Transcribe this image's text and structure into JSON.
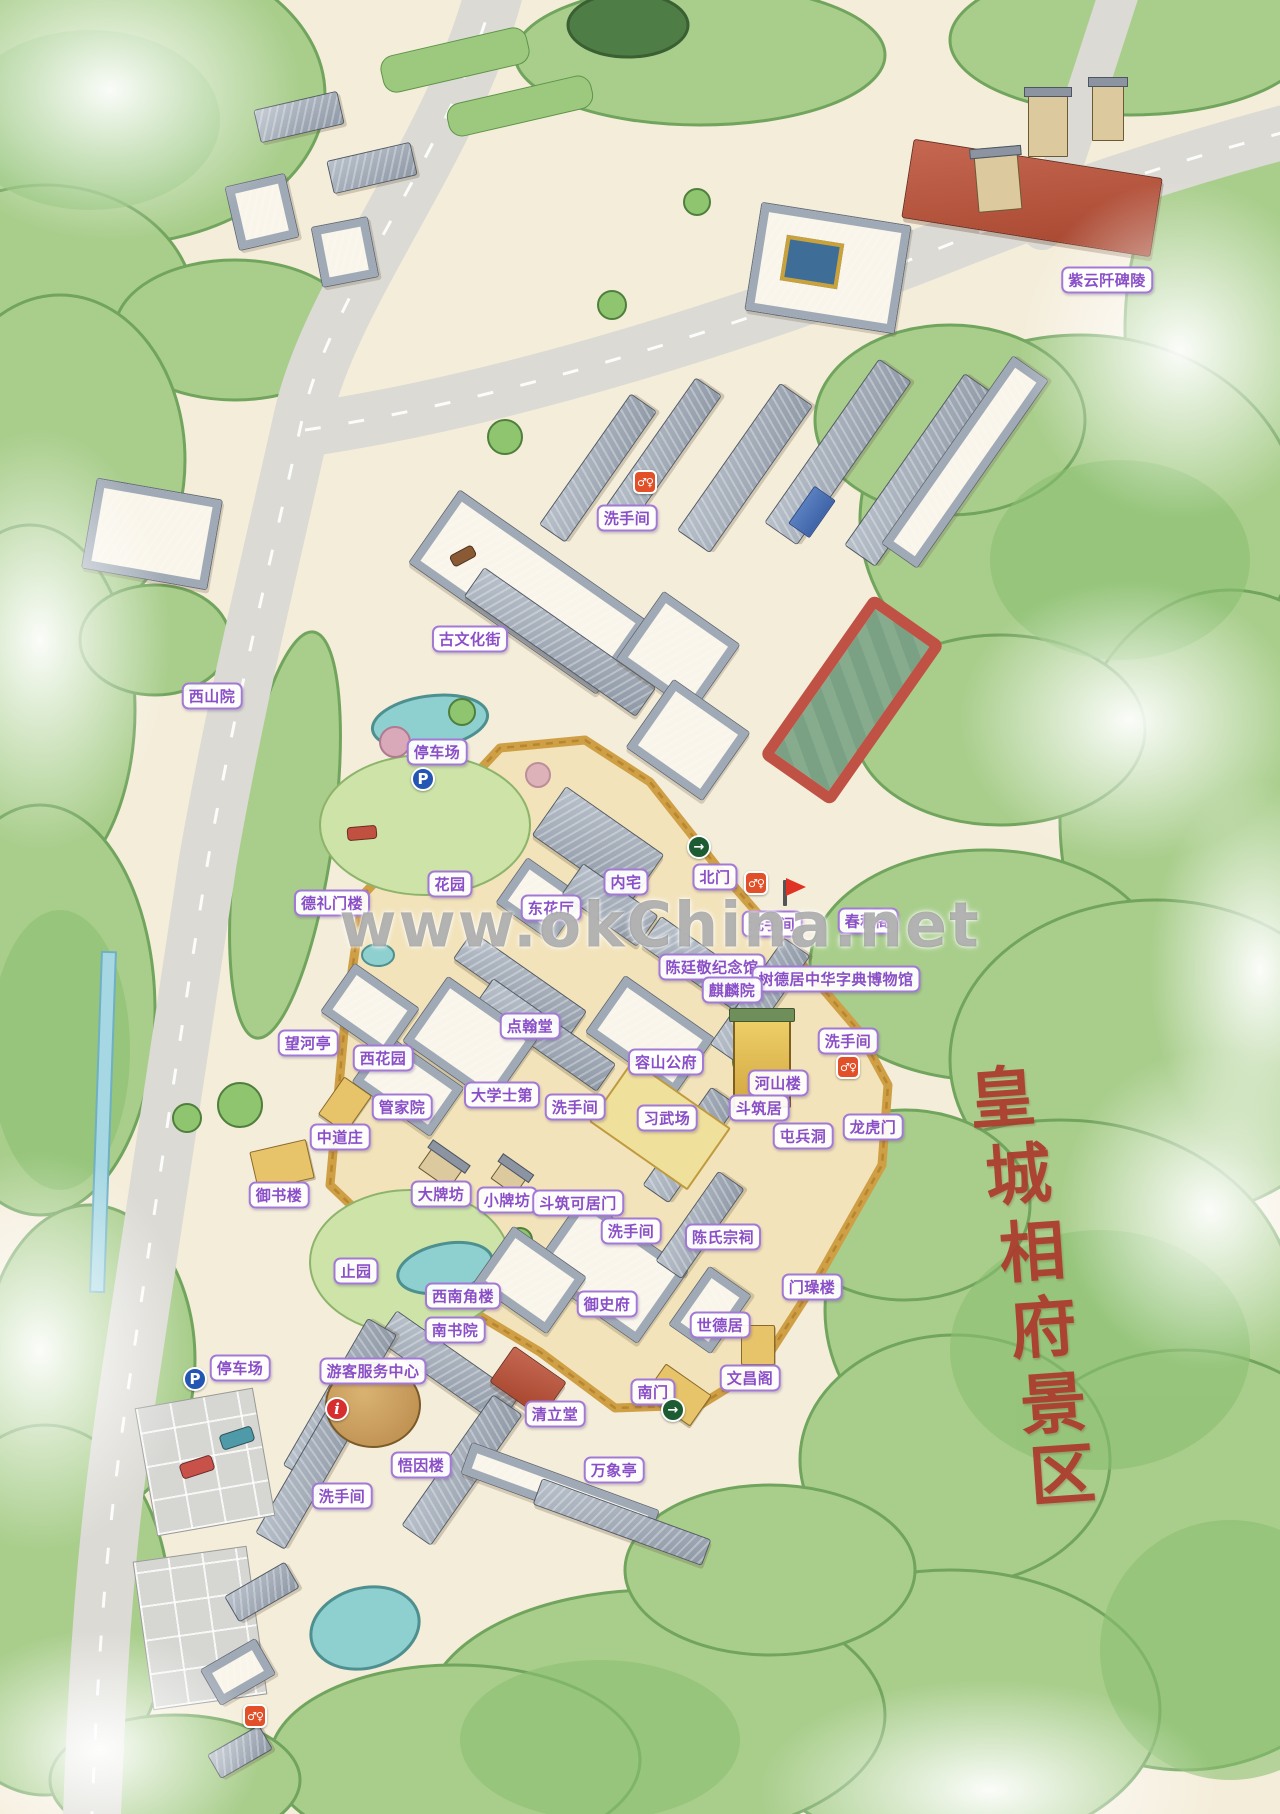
{
  "map": {
    "watermark": "www.okChina.net",
    "vertical_title": {
      "text": "皇城相府景区",
      "color": "#ac3a2d",
      "chars": [
        {
          "ch": "皇",
          "x": 1002,
          "y": 1093
        },
        {
          "ch": "城",
          "x": 1018,
          "y": 1170
        },
        {
          "ch": "相",
          "x": 1032,
          "y": 1247
        },
        {
          "ch": "府",
          "x": 1043,
          "y": 1323
        },
        {
          "ch": "景",
          "x": 1053,
          "y": 1399
        },
        {
          "ch": "区",
          "x": 1062,
          "y": 1470
        }
      ]
    },
    "label_style": {
      "text_color": "#8a4fc8",
      "border_color": "#a379d6",
      "background": "#ffffff"
    },
    "labels": [
      {
        "text": "紫云阡碑陵",
        "x": 1107,
        "y": 280
      },
      {
        "text": "洗手间",
        "x": 627,
        "y": 518
      },
      {
        "text": "古文化街",
        "x": 470,
        "y": 639
      },
      {
        "text": "西山院",
        "x": 212,
        "y": 696
      },
      {
        "text": "停车场",
        "x": 437,
        "y": 752
      },
      {
        "text": "花园",
        "x": 450,
        "y": 884
      },
      {
        "text": "德礼门楼",
        "x": 332,
        "y": 903
      },
      {
        "text": "内宅",
        "x": 626,
        "y": 882
      },
      {
        "text": "北门",
        "x": 715,
        "y": 877
      },
      {
        "text": "东花厅",
        "x": 551,
        "y": 908
      },
      {
        "text": "洗手间",
        "x": 772,
        "y": 924
      },
      {
        "text": "春秋阁",
        "x": 868,
        "y": 921
      },
      {
        "text": "陈廷敬纪念馆",
        "x": 712,
        "y": 967
      },
      {
        "text": "树德居中华字典博物馆",
        "x": 836,
        "y": 979
      },
      {
        "text": "麒麟院",
        "x": 732,
        "y": 990
      },
      {
        "text": "点翰堂",
        "x": 530,
        "y": 1026
      },
      {
        "text": "望河亭",
        "x": 308,
        "y": 1043
      },
      {
        "text": "洗手间",
        "x": 848,
        "y": 1041
      },
      {
        "text": "西花园",
        "x": 383,
        "y": 1058
      },
      {
        "text": "容山公府",
        "x": 666,
        "y": 1062
      },
      {
        "text": "河山楼",
        "x": 778,
        "y": 1083
      },
      {
        "text": "大学士第",
        "x": 502,
        "y": 1095
      },
      {
        "text": "管家院",
        "x": 402,
        "y": 1107
      },
      {
        "text": "洗手间",
        "x": 575,
        "y": 1107
      },
      {
        "text": "斗筑居",
        "x": 759,
        "y": 1108
      },
      {
        "text": "习武场",
        "x": 667,
        "y": 1118
      },
      {
        "text": "龙虎门",
        "x": 873,
        "y": 1127
      },
      {
        "text": "屯兵洞",
        "x": 803,
        "y": 1136
      },
      {
        "text": "中道庄",
        "x": 340,
        "y": 1137
      },
      {
        "text": "御书楼",
        "x": 279,
        "y": 1195
      },
      {
        "text": "大牌坊",
        "x": 441,
        "y": 1194
      },
      {
        "text": "小牌坊",
        "x": 507,
        "y": 1200
      },
      {
        "text": "斗筑可居门",
        "x": 578,
        "y": 1203
      },
      {
        "text": "洗手间",
        "x": 631,
        "y": 1231
      },
      {
        "text": "陈氏宗祠",
        "x": 723,
        "y": 1237
      },
      {
        "text": "止园",
        "x": 356,
        "y": 1271
      },
      {
        "text": "门璪楼",
        "x": 812,
        "y": 1287
      },
      {
        "text": "西南角楼",
        "x": 463,
        "y": 1296
      },
      {
        "text": "御史府",
        "x": 607,
        "y": 1304
      },
      {
        "text": "世德居",
        "x": 720,
        "y": 1325
      },
      {
        "text": "南书院",
        "x": 455,
        "y": 1330
      },
      {
        "text": "停车场",
        "x": 240,
        "y": 1368
      },
      {
        "text": "游客服务中心",
        "x": 373,
        "y": 1371
      },
      {
        "text": "文昌阁",
        "x": 750,
        "y": 1378
      },
      {
        "text": "南门",
        "x": 653,
        "y": 1392
      },
      {
        "text": "清立堂",
        "x": 555,
        "y": 1414
      },
      {
        "text": "悟因楼",
        "x": 421,
        "y": 1465
      },
      {
        "text": "万象亭",
        "x": 614,
        "y": 1470
      },
      {
        "text": "洗手间",
        "x": 342,
        "y": 1496
      }
    ],
    "icons": [
      {
        "type": "wc",
        "glyph": "♂♀",
        "x": 645,
        "y": 482
      },
      {
        "type": "parking",
        "glyph": "P",
        "x": 423,
        "y": 779
      },
      {
        "type": "exit",
        "glyph": "→",
        "x": 699,
        "y": 847
      },
      {
        "type": "wc",
        "glyph": "♂♀",
        "x": 756,
        "y": 883
      },
      {
        "type": "flag",
        "glyph": "",
        "x": 785,
        "y": 893
      },
      {
        "type": "wc",
        "glyph": "♂♀",
        "x": 848,
        "y": 1067
      },
      {
        "type": "parking",
        "glyph": "P",
        "x": 195,
        "y": 1379
      },
      {
        "type": "info",
        "glyph": "i",
        "x": 337,
        "y": 1409
      },
      {
        "type": "exit",
        "glyph": "→",
        "x": 673,
        "y": 1410
      },
      {
        "type": "wc",
        "glyph": "♂♀",
        "x": 255,
        "y": 1716
      }
    ]
  }
}
